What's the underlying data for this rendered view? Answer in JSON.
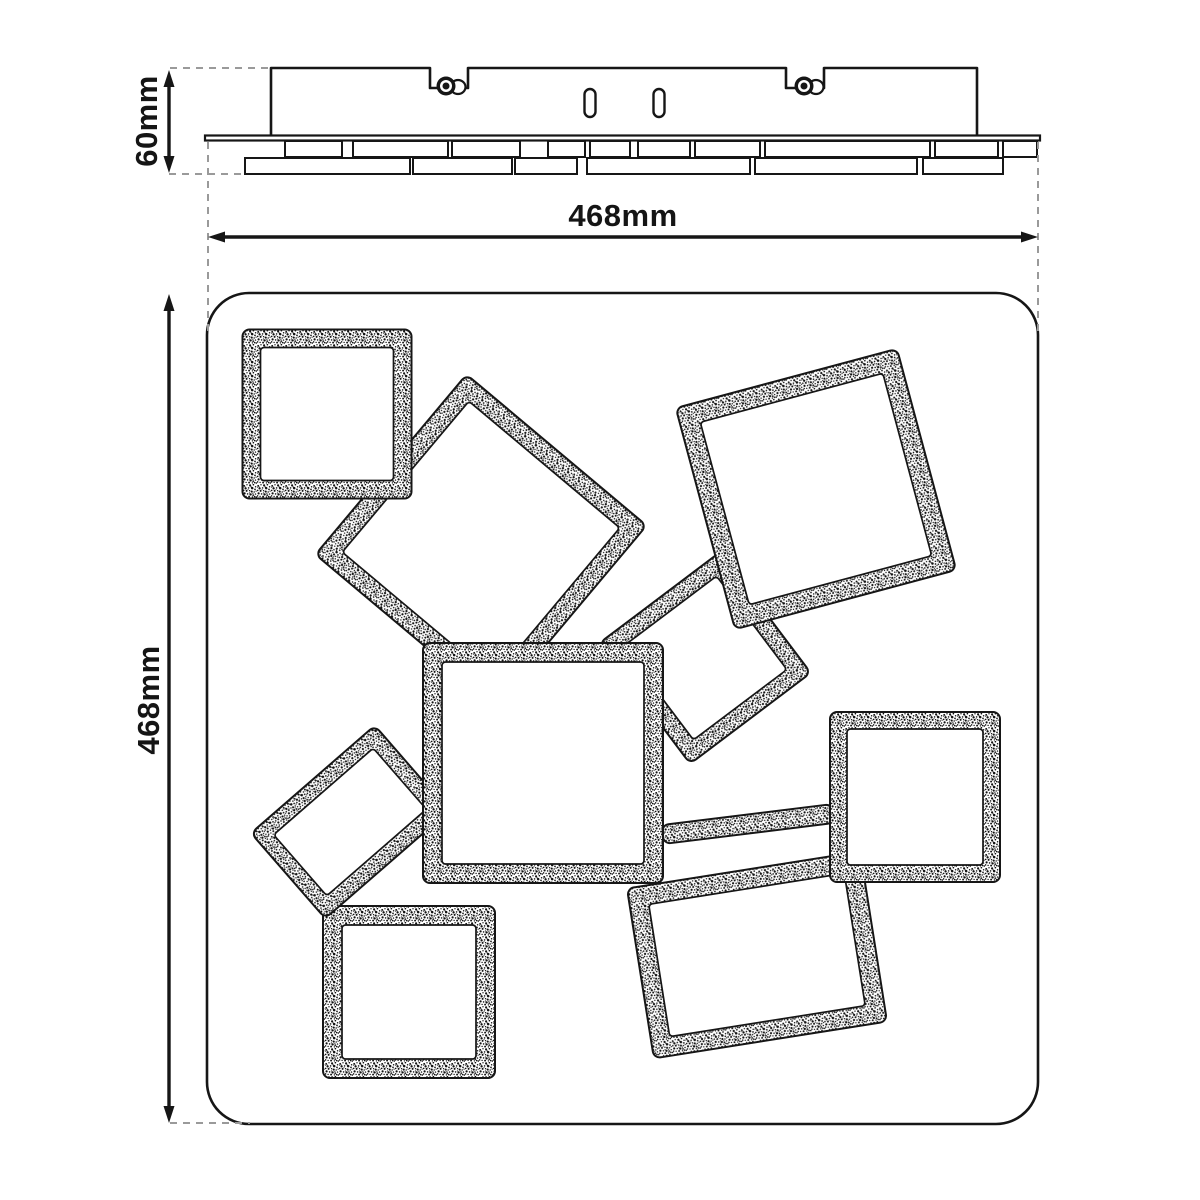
{
  "diagram": {
    "description": "dimension drawing of ceiling light with tilted square LED panels"
  },
  "dimensions": {
    "height": {
      "label": "60mm"
    },
    "width": {
      "label": "468mm"
    },
    "depth": {
      "label": "468mm"
    }
  },
  "colors": {
    "line": "#161616",
    "dash": "#9a9a9a",
    "background": "#ffffff"
  },
  "side_view": {
    "canopy": {
      "x1": 271,
      "x2": 977,
      "top": 68,
      "bottom": 137,
      "notches": [
        {
          "x1": 430,
          "x2": 468,
          "depth": 20
        },
        {
          "x1": 786,
          "x2": 824,
          "depth": 20
        }
      ]
    },
    "screws": [
      {
        "cx": 446,
        "cy": 86
      },
      {
        "cx": 804,
        "cy": 86
      }
    ],
    "slots": [
      {
        "cx": 590,
        "cy": 103
      },
      {
        "cx": 659,
        "cy": 103
      }
    ],
    "plate": {
      "x1": 205,
      "x2": 1040,
      "y": 135.5,
      "h": 5
    },
    "panel_rows": [
      {
        "y": 141,
        "h": 16,
        "segments": [
          [
            285,
            342
          ],
          [
            353,
            448
          ],
          [
            452,
            520
          ],
          [
            548,
            585
          ],
          [
            590,
            630
          ],
          [
            638,
            690
          ],
          [
            695,
            760
          ],
          [
            765,
            930
          ],
          [
            935,
            998
          ],
          [
            1003,
            1037
          ]
        ]
      },
      {
        "y": 158,
        "h": 16,
        "segments": [
          [
            245,
            410
          ],
          [
            413,
            512
          ],
          [
            515,
            577
          ],
          [
            587,
            750
          ],
          [
            755,
            917
          ],
          [
            923,
            1003
          ]
        ]
      }
    ]
  },
  "top_view": {
    "plate": {
      "x": 207,
      "y": 293,
      "w": 831,
      "h": 831,
      "r": 42
    },
    "squares": [
      {
        "name": "square-panel-4",
        "cx": 705,
        "cy": 658,
        "w": 151,
        "h": 151,
        "rot": 53,
        "bw": 17
      },
      {
        "name": "square-panel-2",
        "cx": 481,
        "cy": 540,
        "w": 235,
        "h": 235,
        "rot": 40,
        "bw": 19
      },
      {
        "name": "square-panel-8",
        "cx": 757,
        "cy": 955,
        "w": 236,
        "h": 172,
        "rot": -9,
        "bw": 19
      },
      {
        "name": "connector-bar",
        "cx": 748,
        "cy": 824,
        "w": 172,
        "h": 19,
        "rot": -7,
        "bw": 0
      },
      {
        "name": "square-panel-7",
        "cx": 409,
        "cy": 992,
        "w": 172,
        "h": 172,
        "rot": 0,
        "bw": 19
      },
      {
        "name": "square-panel-6",
        "cx": 350,
        "cy": 822,
        "w": 164,
        "h": 113,
        "rot": -41,
        "bw": 16
      },
      {
        "name": "square-panel-1",
        "cx": 327,
        "cy": 414,
        "w": 169,
        "h": 169,
        "rot": 0,
        "bw": 18
      },
      {
        "name": "square-panel-3",
        "cx": 816,
        "cy": 489,
        "w": 229,
        "h": 229,
        "rot": -15,
        "bw": 20
      },
      {
        "name": "square-panel-9",
        "cx": 915,
        "cy": 797,
        "w": 170,
        "h": 170,
        "rot": 0,
        "bw": 17
      },
      {
        "name": "square-panel-5",
        "cx": 543,
        "cy": 763,
        "w": 240,
        "h": 240,
        "rot": 0,
        "bw": 19
      }
    ]
  },
  "dimension_lines": {
    "height": {
      "axis": "v",
      "x": 169,
      "y1": 70,
      "y2": 173,
      "dashes": [
        [
          170,
          68,
          272,
          68
        ],
        [
          169,
          174,
          247,
          174
        ]
      ]
    },
    "width": {
      "axis": "h",
      "y": 237,
      "x1": 208,
      "x2": 1038,
      "dashes": [
        [
          208,
          142,
          208,
          335
        ],
        [
          1038,
          142,
          1038,
          335
        ]
      ]
    },
    "depth": {
      "axis": "v",
      "x": 169,
      "y1": 294,
      "y2": 1123,
      "dashes": [
        [
          170,
          1123,
          250,
          1123
        ]
      ]
    }
  }
}
